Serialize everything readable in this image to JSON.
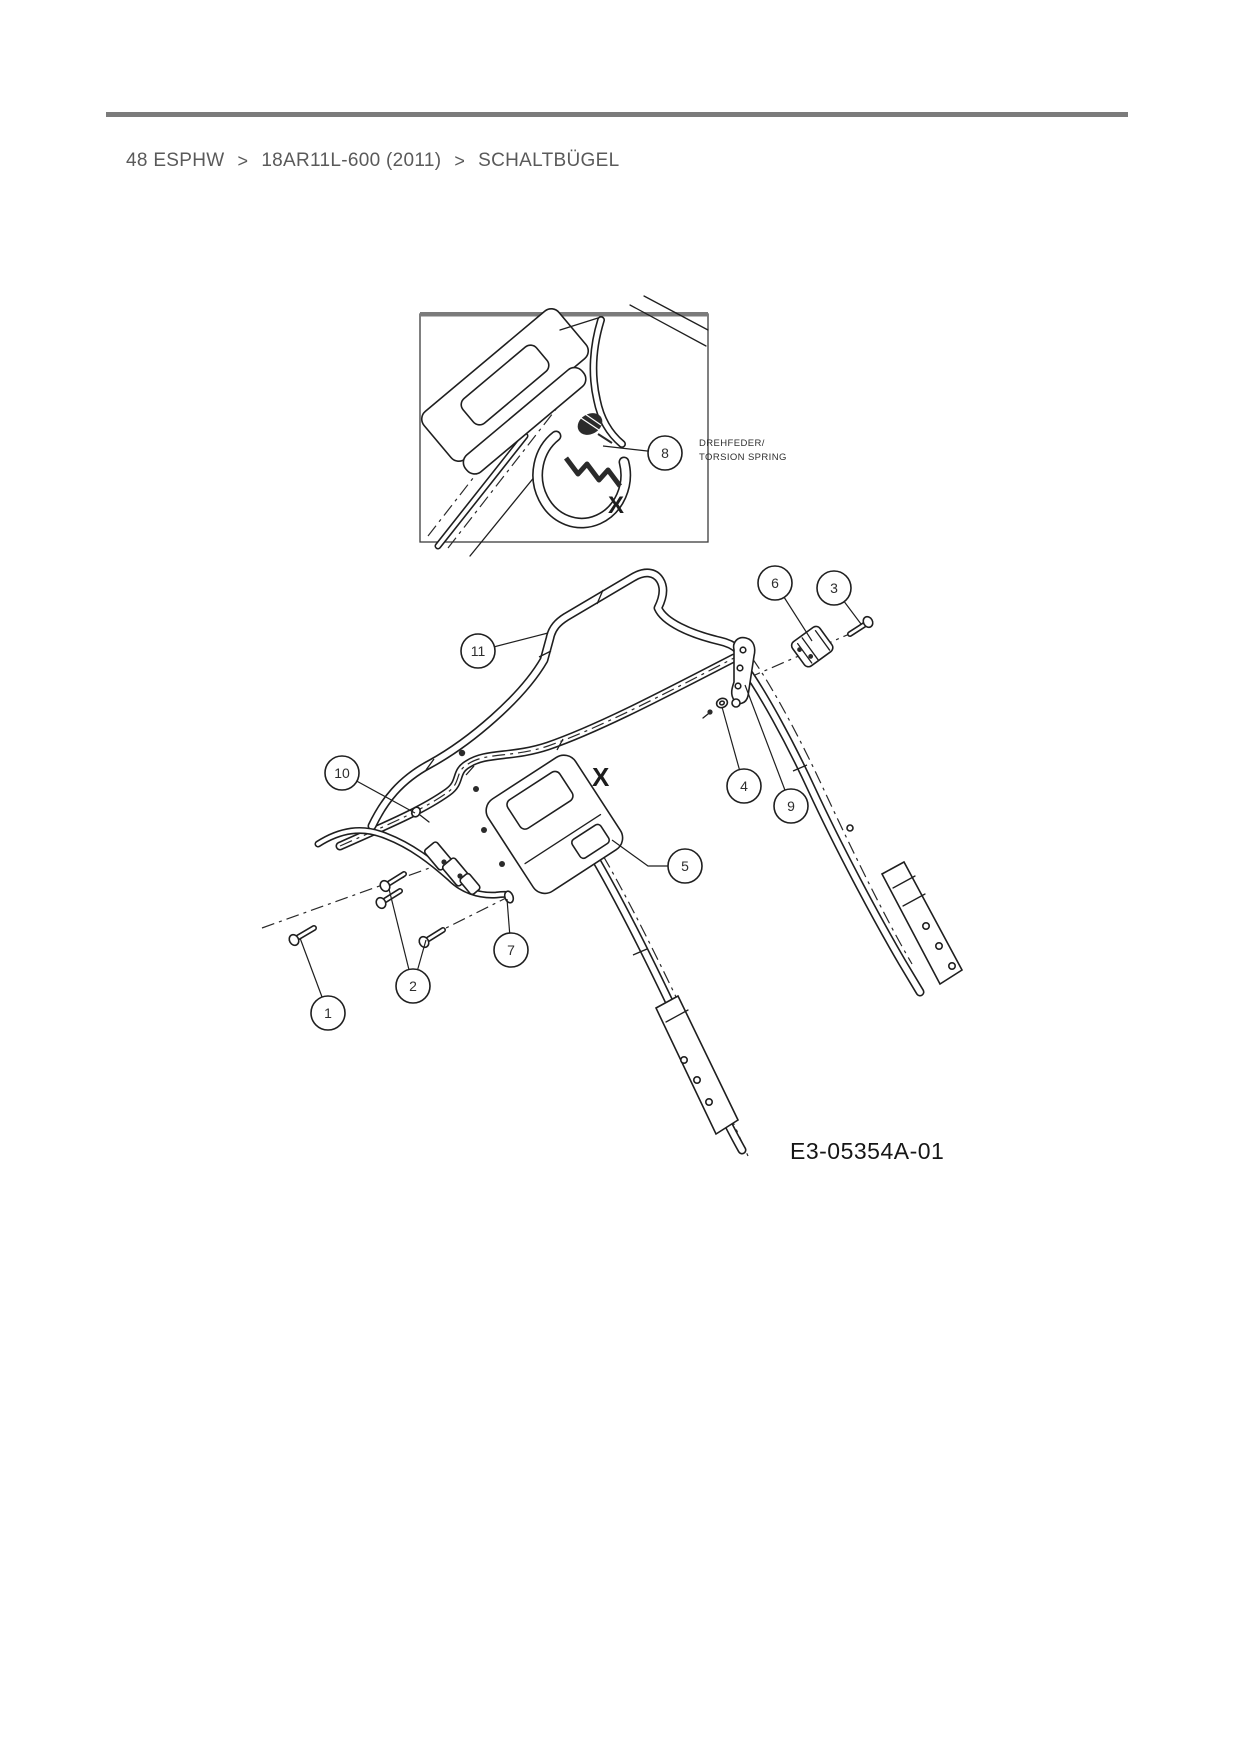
{
  "colors": {
    "top_rule": "#7b7b7b",
    "breadcrumb_text": "#5a5a5a",
    "line": "#1f1f1f"
  },
  "breadcrumb": {
    "items": [
      "48 ESPHW",
      "18AR11L-600 (2011)",
      "SCHALTBÜGEL"
    ],
    "separator": ">"
  },
  "inset": {
    "label_line1": "DREHFEDER/",
    "label_line2": "TORSION SPRING",
    "x_mark": "X"
  },
  "diagram": {
    "x_mark": "X",
    "part_code": "E3-05354A-01"
  },
  "callouts": [
    {
      "num": "1",
      "cx": 328,
      "cy": 1013,
      "leaders": [
        [
          [
            300,
            938
          ]
        ]
      ]
    },
    {
      "num": "2",
      "cx": 413,
      "cy": 986,
      "leaders": [
        [
          [
            389,
            889
          ]
        ],
        [
          [
            426,
            940
          ]
        ]
      ]
    },
    {
      "num": "3",
      "cx": 834,
      "cy": 588,
      "leaders": [
        [
          [
            861,
            624
          ]
        ]
      ]
    },
    {
      "num": "4",
      "cx": 744,
      "cy": 786,
      "leaders": [
        [
          [
            722,
            707
          ]
        ]
      ]
    },
    {
      "num": "5",
      "cx": 685,
      "cy": 866,
      "leaders": [
        [
          [
            648,
            866
          ],
          [
            612,
            840
          ]
        ]
      ]
    },
    {
      "num": "6",
      "cx": 775,
      "cy": 583,
      "leaders": [
        [
          [
            812,
            641
          ]
        ]
      ]
    },
    {
      "num": "7",
      "cx": 511,
      "cy": 950,
      "leaders": [
        [
          [
            507,
            899
          ]
        ]
      ]
    },
    {
      "num": "8",
      "cx": 665,
      "cy": 453,
      "leaders": [
        [
          [
            603,
            446
          ]
        ]
      ]
    },
    {
      "num": "9",
      "cx": 791,
      "cy": 806,
      "leaders": [
        [
          [
            745,
            685
          ]
        ]
      ]
    },
    {
      "num": "10",
      "cx": 342,
      "cy": 773,
      "leaders": [
        [
          [
            415,
            813
          ]
        ]
      ]
    },
    {
      "num": "11",
      "cx": 478,
      "cy": 651,
      "leaders": [
        [
          [
            548,
            633
          ]
        ]
      ]
    }
  ]
}
